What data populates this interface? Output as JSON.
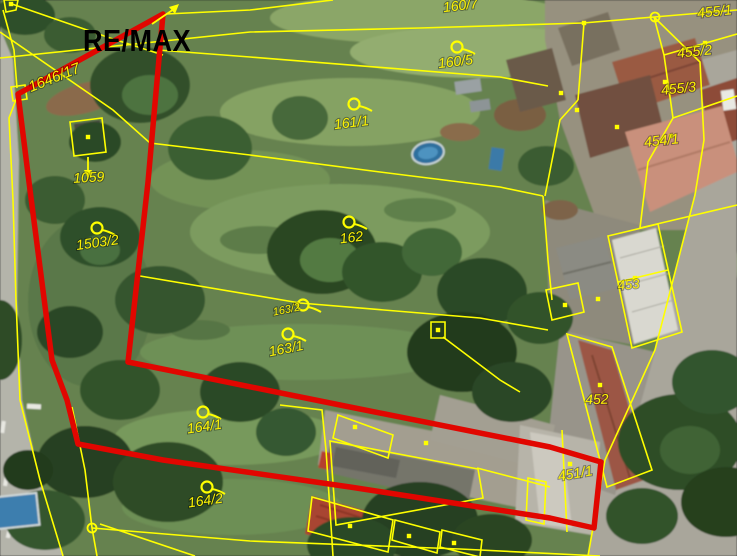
{
  "map": {
    "logo_text": "RE/MAX",
    "colors": {
      "cadastral_line": "#ffff00",
      "boundary_highlight": "#e10600",
      "label_text": "#fdf303",
      "logo_text": "#0b0b0b"
    },
    "parcel_labels": [
      {
        "text": "1646/17",
        "x": 56,
        "y": 82,
        "rot": -22,
        "size": 15
      },
      {
        "text": "1059",
        "x": 89,
        "y": 182,
        "rot": -3,
        "size": 14
      },
      {
        "text": "1503/2",
        "x": 98,
        "y": 247,
        "rot": -8,
        "size": 14
      },
      {
        "text": "160/7",
        "x": 461,
        "y": 10,
        "rot": -7,
        "size": 14
      },
      {
        "text": "160/5",
        "x": 456,
        "y": 66,
        "rot": -7,
        "size": 14
      },
      {
        "text": "161/1",
        "x": 352,
        "y": 127,
        "rot": -7,
        "size": 14
      },
      {
        "text": "162",
        "x": 352,
        "y": 242,
        "rot": -7,
        "size": 14
      },
      {
        "text": "163/2",
        "x": 287,
        "y": 313,
        "rot": -11,
        "size": 11
      },
      {
        "text": "163/1",
        "x": 287,
        "y": 353,
        "rot": -11,
        "size": 14
      },
      {
        "text": "164/1",
        "x": 205,
        "y": 431,
        "rot": -8,
        "size": 14
      },
      {
        "text": "164/2",
        "x": 206,
        "y": 505,
        "rot": -8,
        "size": 14
      },
      {
        "text": "455/1",
        "x": 715,
        "y": 16,
        "rot": -6,
        "size": 14
      },
      {
        "text": "455/2",
        "x": 695,
        "y": 56,
        "rot": -6,
        "size": 14
      },
      {
        "text": "455/3",
        "x": 679,
        "y": 93,
        "rot": -6,
        "size": 14
      },
      {
        "text": "454/1",
        "x": 662,
        "y": 145,
        "rot": -6,
        "size": 14
      },
      {
        "text": "453",
        "x": 629,
        "y": 289,
        "rot": -6,
        "size": 13
      },
      {
        "text": "452",
        "x": 597,
        "y": 404,
        "rot": -2,
        "size": 14
      },
      {
        "text": "451/1",
        "x": 576,
        "y": 478,
        "rot": -10,
        "size": 14
      }
    ],
    "survey_markers": [
      [
        457,
        47
      ],
      [
        354,
        104
      ],
      [
        349,
        222
      ],
      [
        97,
        228
      ],
      [
        303,
        305
      ],
      [
        288,
        334
      ],
      [
        203,
        412
      ],
      [
        207,
        487
      ]
    ],
    "boundary_dots": [
      [
        584,
        23
      ],
      [
        705,
        43
      ],
      [
        665,
        82
      ],
      [
        671,
        136
      ],
      [
        617,
        127
      ],
      [
        635,
        278
      ],
      [
        598,
        299
      ],
      [
        565,
        305
      ],
      [
        600,
        385
      ],
      [
        570,
        464
      ],
      [
        88,
        137
      ],
      [
        11,
        4
      ],
      [
        355,
        427
      ],
      [
        426,
        443
      ],
      [
        350,
        526
      ],
      [
        409,
        536
      ],
      [
        454,
        543
      ],
      [
        438,
        330
      ],
      [
        561,
        93
      ],
      [
        577,
        110
      ]
    ],
    "node_circles": [
      [
        655,
        17
      ],
      [
        92,
        528
      ]
    ],
    "red_boundary_points": "163,14 18,94 30,190 52,360 67,400 78,444 163,460 350,487 550,518 594,528 601,462 550,447 340,405 128,362 148,182",
    "cadastral_lines": [
      "3,10 14,50 17,88",
      "17,97 9,118 13,200 16,300 20,400 40,480 63,556",
      "12,4 110,38 163,55",
      "158,50 250,57 500,77 548,86",
      "0,32 113,110 150,143 250,155 380,172 500,187 543,196",
      "0,58 250,32 420,28 583,23",
      "583,23 654,17",
      "654,17 737,10",
      "654,17 700,62 704,140 695,195 655,350 605,460 588,556",
      "654,17 664,55 673,118 648,162 640,228",
      "664,55 737,34",
      "673,118 737,96",
      "640,228 737,205",
      "584,23 578,100",
      "578,100 560,120 545,196",
      "543,196 548,260 552,300",
      "333,0 250,10 166,14",
      "140,276 300,303 480,318 548,330",
      "280,405 322,410 326,450 333,556",
      "72,407 85,470 92,528 97,556",
      "92,528 250,541 460,549 600,556",
      "100,524 195,556",
      "443,337 500,380 520,392",
      "477,468 550,487",
      "562,430 567,532",
      "618,282 668,270"
    ],
    "cadastral_boxes": [
      "11,87 25,85 27,99 13,101",
      "4,0 18,0 16,10 6,12",
      "70,122 102,118 106,152 74,156",
      "431,322 445,322 445,338 431,338",
      "338,415 393,435 388,458 333,438",
      "330,441 478,469 483,498 336,525",
      "312,497 393,520 388,552 308,531",
      "395,520 440,532 437,553 392,540",
      "442,530 482,540 480,557 440,547",
      "546,290 578,283 584,312 552,320",
      "567,334 612,347 652,470 607,487",
      "528,478 546,482 544,524 526,520",
      "608,236 658,224 682,332 632,348"
    ],
    "arrows": [
      {
        "line": "88,157 88,172",
        "head": "88,179 84,170 92,170"
      },
      {
        "line": "152,24 174,9",
        "head": "179,4 169,7 175,14"
      }
    ]
  }
}
